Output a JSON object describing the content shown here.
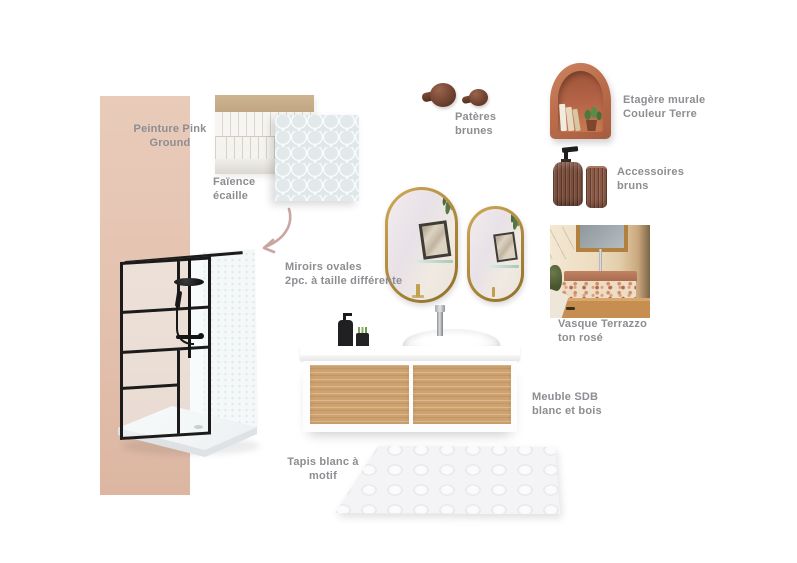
{
  "board": {
    "type": "bathroom moodboard",
    "background": "#ffffff"
  },
  "labels": {
    "paint": {
      "line1": "Peinture Pink",
      "line2": "Ground"
    },
    "faience": {
      "line1": "Faïence",
      "line2": "écaille"
    },
    "hooks": {
      "line1": "Patères",
      "line2": "brunes"
    },
    "shelf": {
      "line1": "Etagère murale",
      "line2": "Couleur Terre"
    },
    "accessories": {
      "line1": "Accessoires",
      "line2": "bruns"
    },
    "mirrors": {
      "line1": "Miroirs ovales",
      "line2": "2pc. à taille différente"
    },
    "basin": {
      "line1": "Vasque Terrazzo",
      "line2": "ton rosé"
    },
    "vanity": {
      "line1": "Meuble SDB",
      "line2": "blanc et bois"
    },
    "rug": {
      "line1": "Tapis blanc à",
      "line2": "motif"
    }
  },
  "colors": {
    "label_text": "#8d8d92",
    "paint_pink": "#e4c2b0",
    "arrow_pink": "#c9a6a2",
    "frame_black": "#1b1b1b",
    "mirror_gold": "#b28d3e",
    "terracotta": "#bc6e4c",
    "hook_brown": "#6f4230",
    "glass_brown": "#7a4e3c",
    "drawer_wood": "#cda26e",
    "vasque_wood": "#c78e51",
    "tile_scale": "#e8edee",
    "rug_white": "#f4f4f6"
  }
}
